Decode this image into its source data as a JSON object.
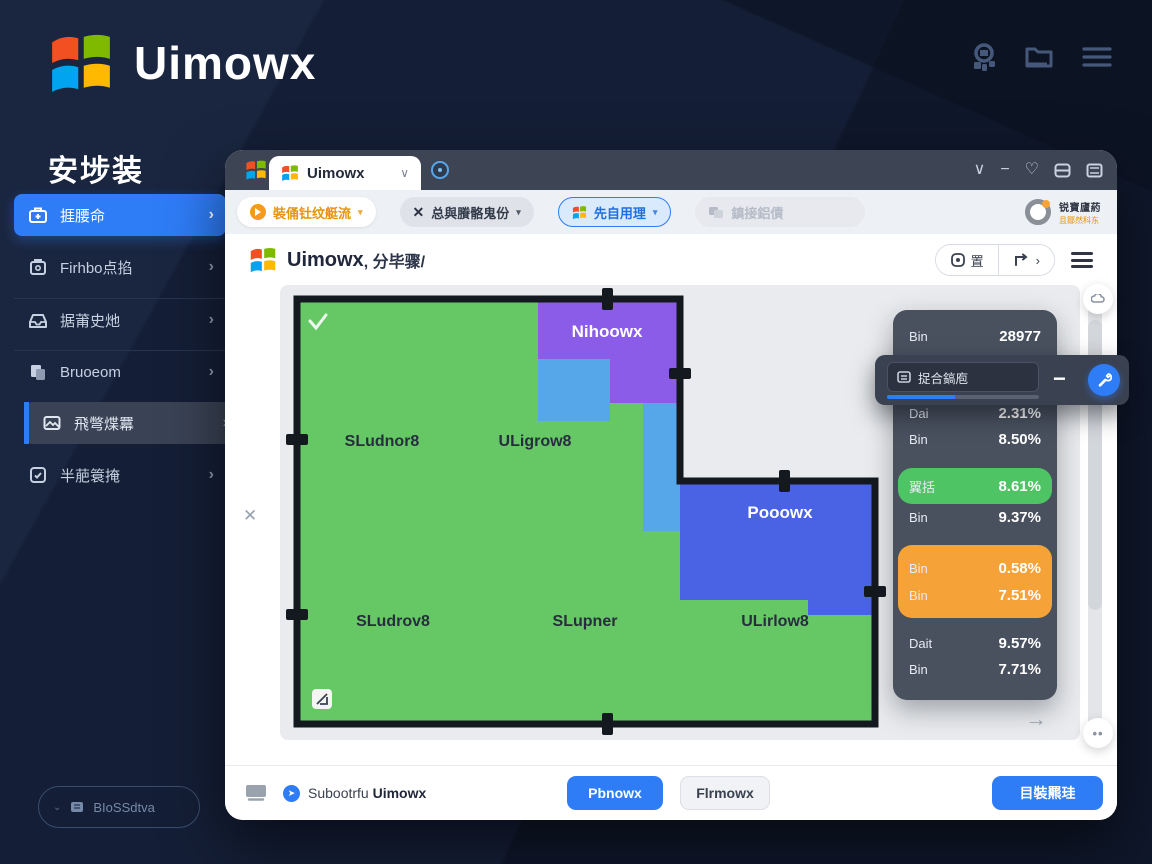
{
  "brand": {
    "name": "Uimowx"
  },
  "sidebar": {
    "title": "安埗装",
    "items": [
      {
        "label": "捱腰命"
      },
      {
        "label": "Firhbo点掐"
      },
      {
        "label": "据莆史灺"
      },
      {
        "label": "Bruoeom"
      },
      {
        "label": "飛彆煠羃"
      },
      {
        "label": "半萉簑掩"
      }
    ],
    "bios_button": {
      "label": "BIoSSdtva"
    }
  },
  "window": {
    "tabbar": {
      "tab": "Uimowx"
    },
    "toolbar": {
      "filter_button": "裝俑钍纹艇流",
      "mode_button": "总與賸骼鬼份",
      "active_button": "先自用理",
      "disabled_button": "鎮接鋁債",
      "account": {
        "line1": "锐寶廬葯",
        "line2": "且鄒然科东"
      }
    },
    "titlebar": {
      "app": "Uimowx",
      "suffix": ", 分毕骤/",
      "zoom_segment": "置"
    },
    "map": {
      "region_purple": "Nihoowx",
      "region_blue": "Pooowx",
      "label_1": "SLudnor8",
      "label_2": "ULigrow8",
      "label_3": "SLudrov8",
      "label_4": "SLupner",
      "label_5": "ULirlow8"
    },
    "popup": {
      "field_text": "捉合鎬庖",
      "progress_pct": 45
    },
    "stats": {
      "row1_label": "Bin",
      "row1_value": "28977",
      "row2_label": "Dai",
      "row2_value": "2.31%",
      "row3_label": "Bin",
      "row3_value": "8.50%",
      "row4_label": "翼括",
      "row4_value": "8.61%",
      "row5_label": "Bin",
      "row5_value": "9.37%",
      "row6_label": "Bin",
      "row6_value": "0.58%",
      "row7_label": "Bin",
      "row7_value": "7.51%",
      "row8_label": "Dait",
      "row8_value": "9.57%",
      "row9_label": "Bin",
      "row9_value": "7.71%"
    },
    "footer": {
      "status_prefix": "Subootrfu",
      "status_app": "Uimowx",
      "confirm_button": "Pbnowx",
      "cancel_button": "Flrmowx",
      "action_button": "目裝羆珪"
    }
  },
  "icons": {
    "chevron_right": "›",
    "window_chevron": "∨",
    "minimize": "−",
    "heart": "♡",
    "minus": "−",
    "arrow_right": "→",
    "dots": "••",
    "redo_chevron": "›",
    "check": "✓"
  },
  "colors": {
    "accent_blue": "#2e7cf6",
    "map_green": "#66c865",
    "map_purple": "#8a5ce8",
    "map_light_blue": "#56a6ea",
    "map_royal_blue": "#4a63e4",
    "row_green": "#4fc465",
    "row_orange": "#f5a238",
    "panel_dark": "#49515f",
    "background": "#141e36"
  }
}
